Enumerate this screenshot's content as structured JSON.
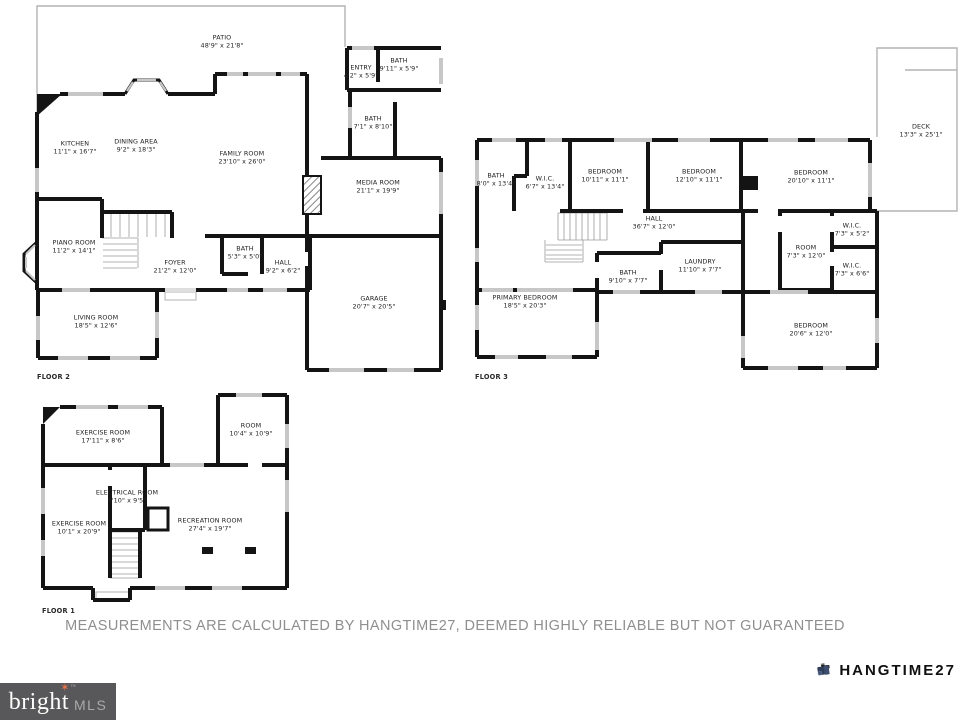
{
  "floors": [
    {
      "label": "FLOOR 2",
      "rooms": [
        {
          "name": "PATIO",
          "dims": "48'9\" x 21'8\""
        },
        {
          "name": "KITCHEN",
          "dims": "11'1\" x 16'7\""
        },
        {
          "name": "DINING AREA",
          "dims": "9'2\" x 18'3\""
        },
        {
          "name": "FAMILY ROOM",
          "dims": "23'10\" x 26'0\""
        },
        {
          "name": "MEDIA ROOM",
          "dims": "21'1\" x 19'9\""
        },
        {
          "name": "ENTRY",
          "dims": "4'2\" x 5'9\""
        },
        {
          "name": "BATH",
          "dims": "9'11\" x 5'9\""
        },
        {
          "name": "BATH",
          "dims": "7'1\" x 8'10\""
        },
        {
          "name": "PIANO ROOM",
          "dims": "11'2\" x 14'1\""
        },
        {
          "name": "FOYER",
          "dims": "21'2\" x 12'0\""
        },
        {
          "name": "BATH",
          "dims": "5'3\" x 5'0\""
        },
        {
          "name": "HALL",
          "dims": "9'2\" x 6'2\""
        },
        {
          "name": "LIVING ROOM",
          "dims": "18'5\" x 12'6\""
        },
        {
          "name": "GARAGE",
          "dims": "20'7\" x 20'5\""
        }
      ]
    },
    {
      "label": "FLOOR 3",
      "rooms": [
        {
          "name": "DECK",
          "dims": "13'3\" x 25'1\""
        },
        {
          "name": "BATH",
          "dims": "8'0\" x 13'4\""
        },
        {
          "name": "W.I.C.",
          "dims": "6'7\" x 13'4\""
        },
        {
          "name": "BEDROOM",
          "dims": "10'11\" x 11'1\""
        },
        {
          "name": "BEDROOM",
          "dims": "12'10\" x 11'1\""
        },
        {
          "name": "BEDROOM",
          "dims": "20'10\" x 11'1\""
        },
        {
          "name": "HALL",
          "dims": "36'7\" x 12'0\""
        },
        {
          "name": "BATH",
          "dims": "9'10\" x 7'7\""
        },
        {
          "name": "LAUNDRY",
          "dims": "11'10\" x 7'7\""
        },
        {
          "name": "PRIMARY BEDROOM",
          "dims": "18'5\" x 20'3\""
        },
        {
          "name": "ROOM",
          "dims": "7'3\" x 12'0\""
        },
        {
          "name": "W.I.C.",
          "dims": "7'3\" x 5'2\""
        },
        {
          "name": "W.I.C.",
          "dims": "7'3\" x 6'6\""
        },
        {
          "name": "BEDROOM",
          "dims": "20'6\" x 12'0\""
        }
      ]
    },
    {
      "label": "FLOOR 1",
      "rooms": [
        {
          "name": "EXERCISE ROOM",
          "dims": "17'11\" x 8'6\""
        },
        {
          "name": "ROOM",
          "dims": "10'4\" x 10'9\""
        },
        {
          "name": "ELECTRICAL ROOM",
          "dims": "4'10\" x 9'5\""
        },
        {
          "name": "EXERCISE ROOM",
          "dims": "10'1\" x 20'9\""
        },
        {
          "name": "RECREATION ROOM",
          "dims": "27'4\" x 19'7\""
        }
      ]
    }
  ],
  "disclaimer": "MEASUREMENTS ARE CALCULATED BY HANGTIME27, DEEMED HIGHLY RELIABLE BUT NOT GUARANTEED",
  "branding": {
    "mls": {
      "word": "bright",
      "suffix": "MLS",
      "tm": "™",
      "star": "✶",
      "bg_color": "#58585a",
      "star_color": "#e8734a"
    },
    "photographer": {
      "name": "HANGTIME27",
      "icon_color": "#2e3d59"
    }
  }
}
